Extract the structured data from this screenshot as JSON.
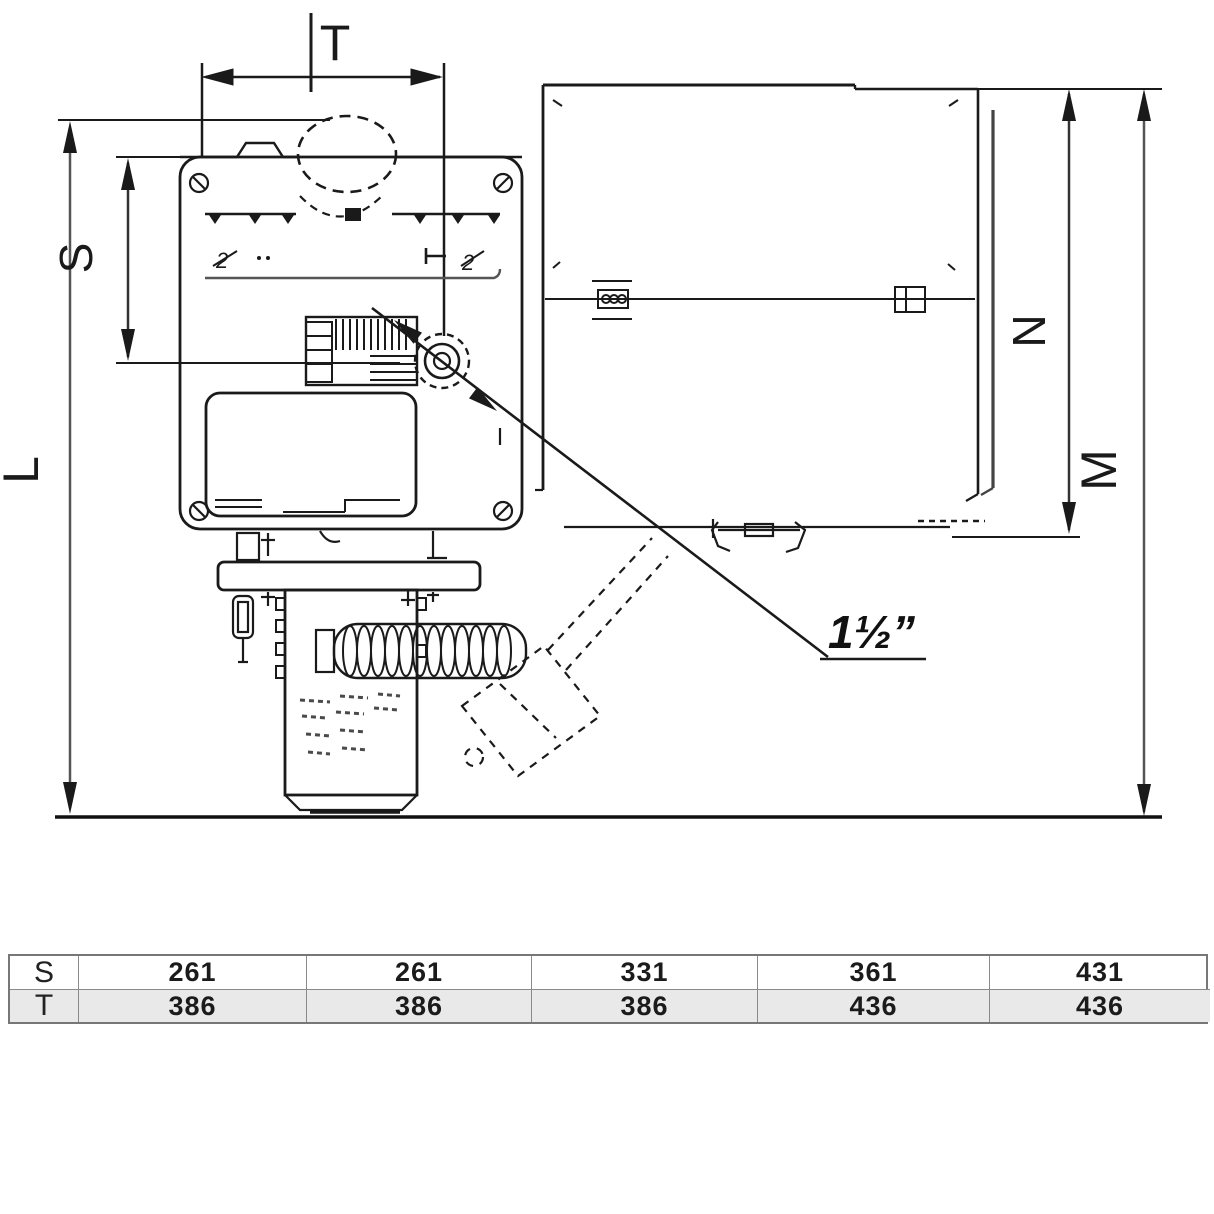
{
  "drawing": {
    "dimension_labels": {
      "width_top": "T",
      "height_upper": "S",
      "height_total_left": "L",
      "height_inner_right": "N",
      "height_total_right": "M"
    },
    "connection_label": "1½”",
    "panel_marks": {
      "left_glyph": "2",
      "right_glyph": "2"
    }
  },
  "table": {
    "rows": [
      {
        "label": "S",
        "values": [
          "261",
          "261",
          "331",
          "361",
          "431"
        ]
      },
      {
        "label": "T",
        "values": [
          "386",
          "386",
          "386",
          "436",
          "436"
        ]
      }
    ]
  },
  "colors": {
    "line": "#1a1a1a",
    "gray_line": "#8a8a8a",
    "table_row_alt": "#e9e9e9",
    "table_border": "#777777",
    "background": "#ffffff"
  }
}
